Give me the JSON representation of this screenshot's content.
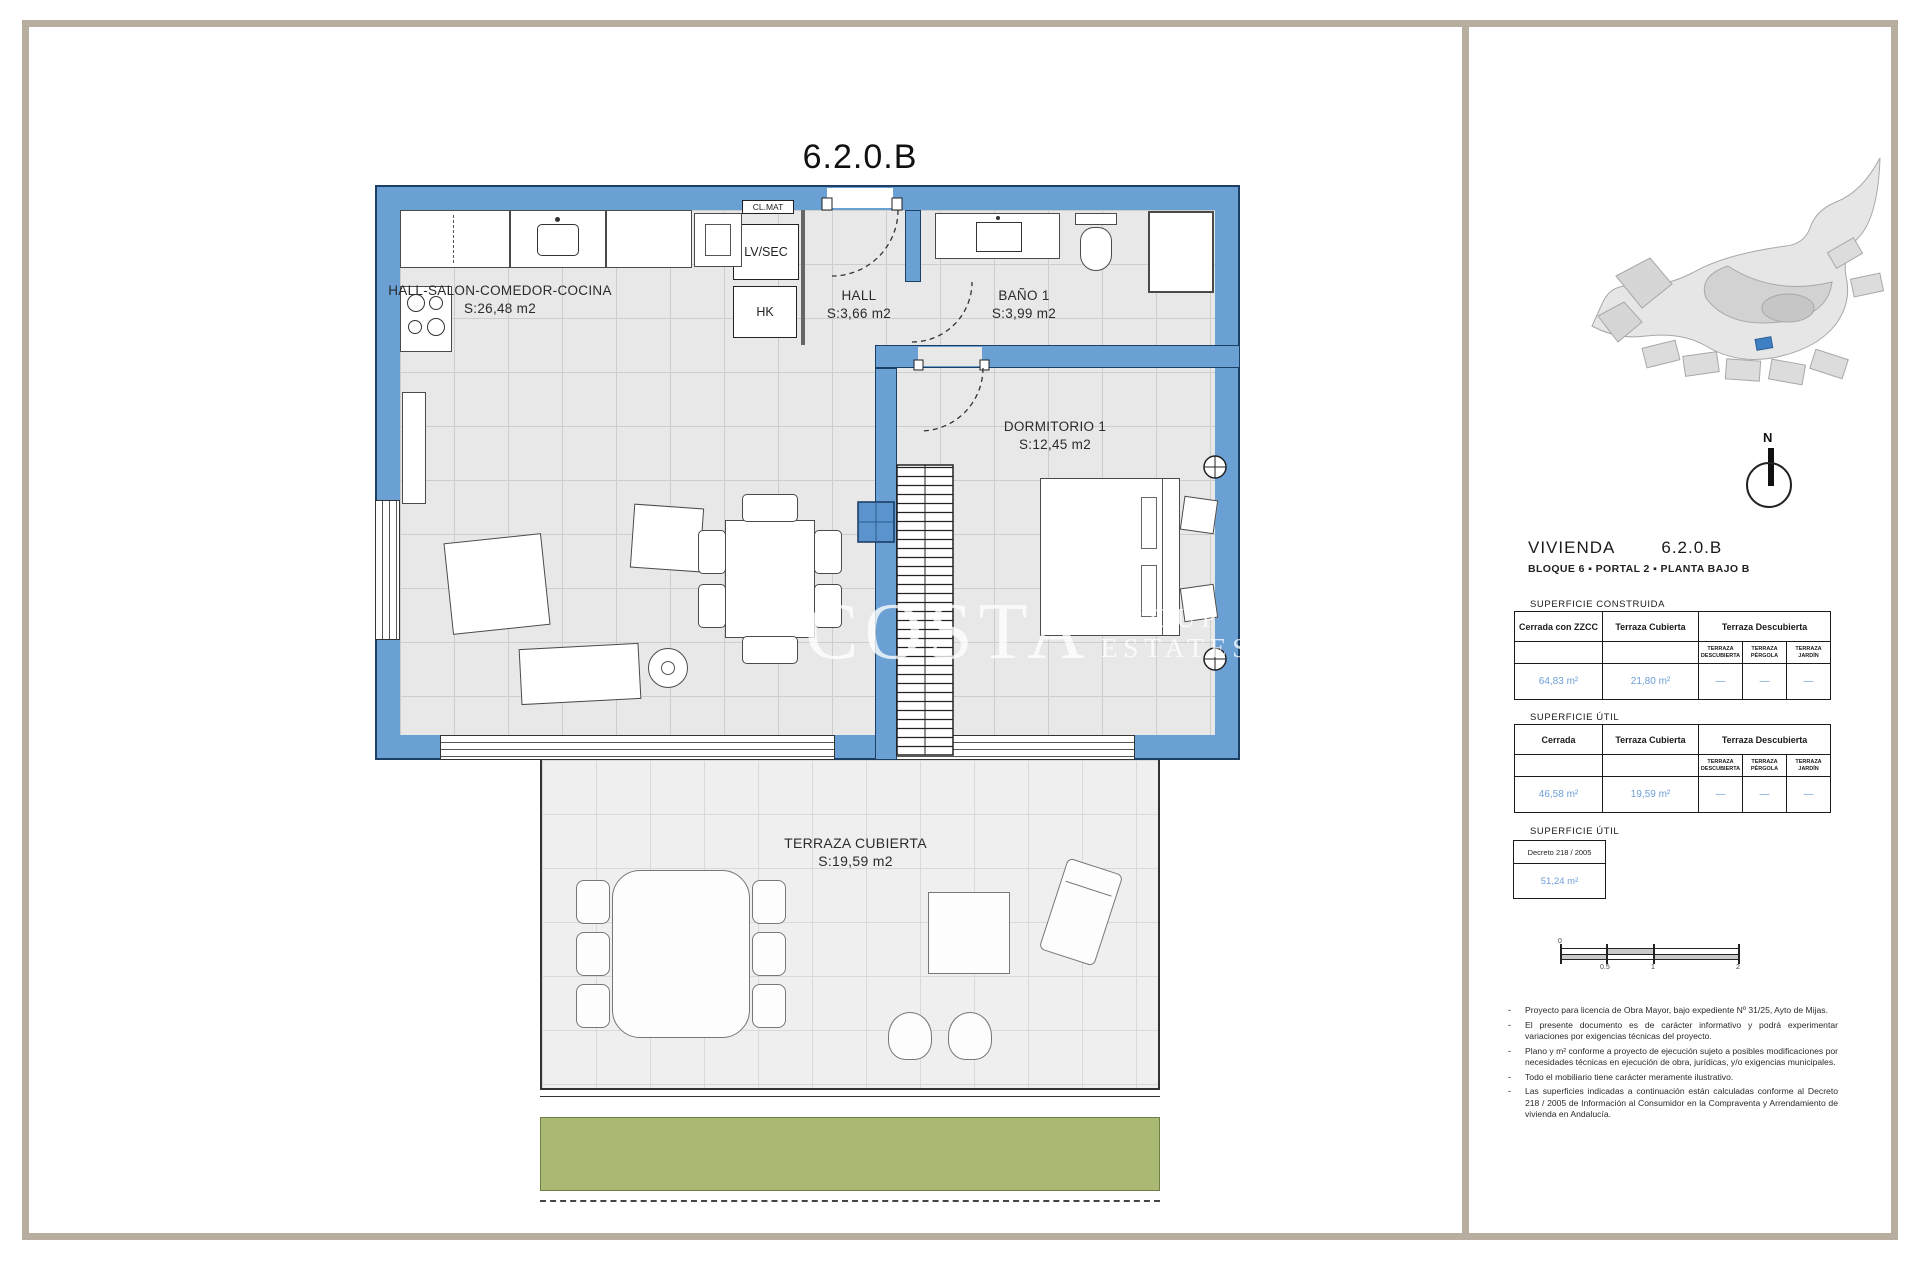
{
  "plan": {
    "title": "6.2.0.B",
    "labels": {
      "cl_mat": "CL.MAT",
      "lv_sec": "LV/SEC",
      "hk": "HK"
    },
    "rooms": [
      {
        "name": "HALL-SALON-COMEDOR-COCINA",
        "area": "S:26,48 m2"
      },
      {
        "name": "HALL",
        "area": "S:3,66 m2"
      },
      {
        "name": "BAÑO 1",
        "area": "S:3,99 m2"
      },
      {
        "name": "DORMITORIO 1",
        "area": "S:12,45 m2"
      },
      {
        "name": "TERRAZA CUBIERTA",
        "area": "S:19,59 m2"
      }
    ]
  },
  "watermark": {
    "line1": "COSTA",
    "line2": "GROUP",
    "line3": "ESTATES"
  },
  "sidebar": {
    "compass": "N",
    "unit": {
      "title": "VIVIENDA",
      "code": "6.2.0.B",
      "subtitle": "BLOQUE 6 ▪ PORTAL 2 ▪ PLANTA BAJO B"
    },
    "construida": {
      "heading": "SUPERFICIE CONSTRUIDA",
      "col1": "Cerrada con ZZCC",
      "col2": "Terraza Cubierta",
      "col3": "Terraza Descubierta",
      "sub": [
        "TERRAZA DESCUBIERTA",
        "TERRAZA PÉRGOLA",
        "TERRAZA JARDÍN"
      ],
      "values": [
        "64,83 m²",
        "21,80 m²",
        "—",
        "—",
        "—"
      ]
    },
    "util": {
      "heading": "SUPERFICIE ÚTIL",
      "col1": "Cerrada",
      "col2": "Terraza Cubierta",
      "col3": "Terraza Descubierta",
      "sub": [
        "TERRAZA DESCUBIERTA",
        "TERRAZA PÉRGOLA",
        "TERRAZA JARDÍN"
      ],
      "values": [
        "46,58 m²",
        "19,59 m²",
        "—",
        "—",
        "—"
      ]
    },
    "decreto": {
      "heading": "SUPERFICIE ÚTIL",
      "box_title": "Decreto 218 / 2005",
      "value": "51,24 m²"
    },
    "scalebar": {
      "ticks": [
        "0",
        "0.5",
        "1",
        "2"
      ]
    },
    "note_marker": "-",
    "notes": [
      "Proyecto para licencia de Obra Mayor, bajo expediente Nº 31/25, Ayto de Mijas.",
      "El presente documento es de carácter informativo y podrá experimentar variaciones por exigencias técnicas del proyecto.",
      "Plano y m² conforme a proyecto de ejecución sujeto a posibles modificaciones por necesidades técnicas en ejecución de obra, jurídicas, y/o exigencias municipales.",
      "Todo el mobiliario tiene carácter meramente ilustrativo.",
      "Las superficies indicadas a continuación están calculadas conforme al Decreto 218 / 2005 de Información al Consumidor en la Compraventa y Arrendamiento de vivienda en Andalucía."
    ]
  },
  "colors": {
    "wall_blue": "#6ba0d4",
    "value_blue": "#6d9ed6",
    "frame_tan": "#b7ae9f",
    "garden_green": "#a9b873"
  }
}
